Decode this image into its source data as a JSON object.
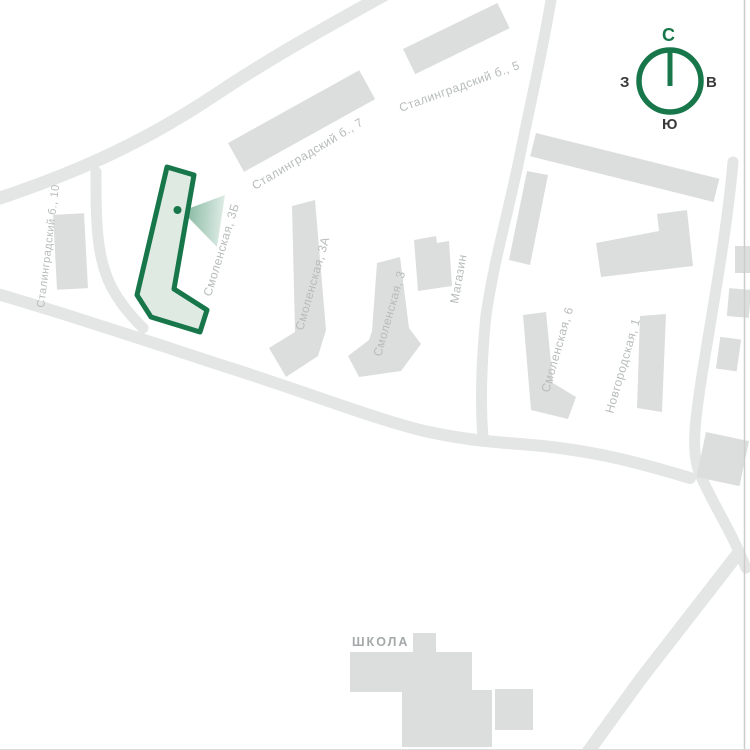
{
  "map": {
    "labels": {
      "stalingradsky_10": "Сталинградский б., 10",
      "stalingradsky_7": "Сталинградский б., 7",
      "stalingradsky_5": "Сталинградский б., 5",
      "smolenskaya_3b": "Смоленская, 3Б",
      "smolenskaya_3a": "Смоленская, 3А",
      "smolenskaya_3": "Смоленская, 3",
      "magazin": "Магазин",
      "smolenskaya_6": "Смоленская, 6",
      "novgorodskaya_1": "Новгородская, 1",
      "school": "ШКОЛА"
    },
    "highlighted_building": "Смоленская, 3Б"
  },
  "compass": {
    "north": "С",
    "east": "В",
    "south": "Ю",
    "west": "З"
  },
  "colors": {
    "green": "#17774a",
    "highlight_fill": "#dfeae3",
    "road": "#e4e5e5",
    "building": "#dcdedd",
    "label": "#b7bbbb",
    "school_label": "#a3a8a8",
    "dark": "#3b3b3b",
    "border": "#cccccc",
    "bg": "#ffffff"
  }
}
